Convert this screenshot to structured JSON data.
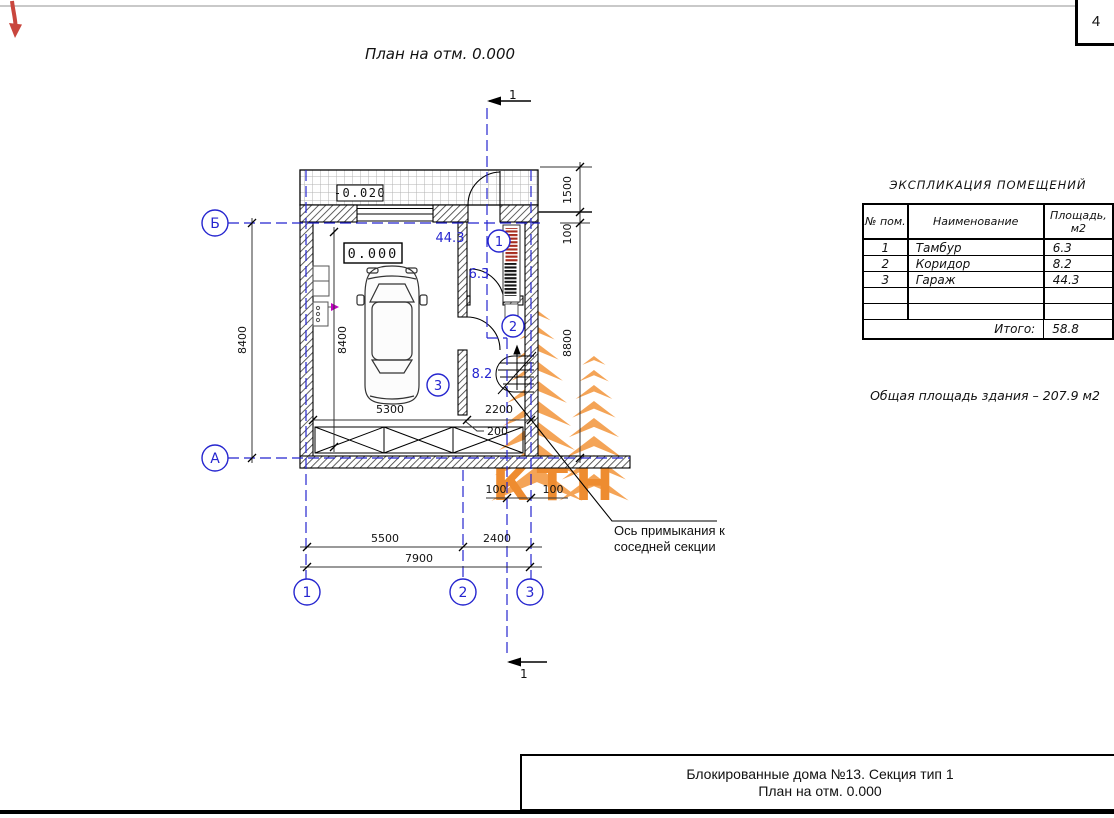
{
  "page": {
    "sheet_number": "4"
  },
  "header": {
    "drawing_title": "План на отм. 0.000"
  },
  "plan": {
    "elevations": {
      "terrace": "-0.020",
      "floor": "0.000"
    },
    "axis_labels": {
      "b": "Б",
      "a": "А",
      "v1": "1",
      "v2": "2",
      "v3": "3"
    },
    "section_label": "1",
    "rooms": {
      "tambour": {
        "tag": "1",
        "area": "6.3"
      },
      "corridor": {
        "tag": "2",
        "area": "8.2"
      },
      "garage": {
        "tag": "3",
        "area": "44.3"
      }
    },
    "dims": {
      "left_8400": "8400",
      "inner_8400": "8400",
      "car_5300": "5300",
      "stairs_2200": "2200",
      "wall_200": "200",
      "right_1500": "1500",
      "right_100": "100",
      "right_8800": "8800",
      "bottom_5500": "5500",
      "bottom_2400": "2400",
      "bottom_7900": "7900",
      "offset_100_left": "100",
      "offset_100_right": "100"
    },
    "leader_note": {
      "line1": "Ось примыкания к",
      "line2": "соседней секции"
    },
    "watermark_letters": "КТН"
  },
  "explication": {
    "title": "ЭКСПЛИКАЦИЯ  ПОМЕЩЕНИЙ",
    "headers": {
      "num": "№ пом.",
      "name": "Наименование",
      "area_1": "Площадь,",
      "area_2": "м2"
    },
    "rows": [
      {
        "num": "1",
        "name": "Тамбур",
        "area": "6.3"
      },
      {
        "num": "2",
        "name": "Коридор",
        "area": "8.2"
      },
      {
        "num": "3",
        "name": "Гараж",
        "area": "44.3"
      },
      {
        "num": "",
        "name": "",
        "area": ""
      },
      {
        "num": "",
        "name": "",
        "area": ""
      }
    ],
    "total_label": "Итого:",
    "total_value": "58.8",
    "note": "Общая площадь здания – 207.9 м2"
  },
  "title_block": {
    "line1": "Блокированные дома №13. Секция тип 1",
    "line2": "План на отм. 0.000"
  }
}
